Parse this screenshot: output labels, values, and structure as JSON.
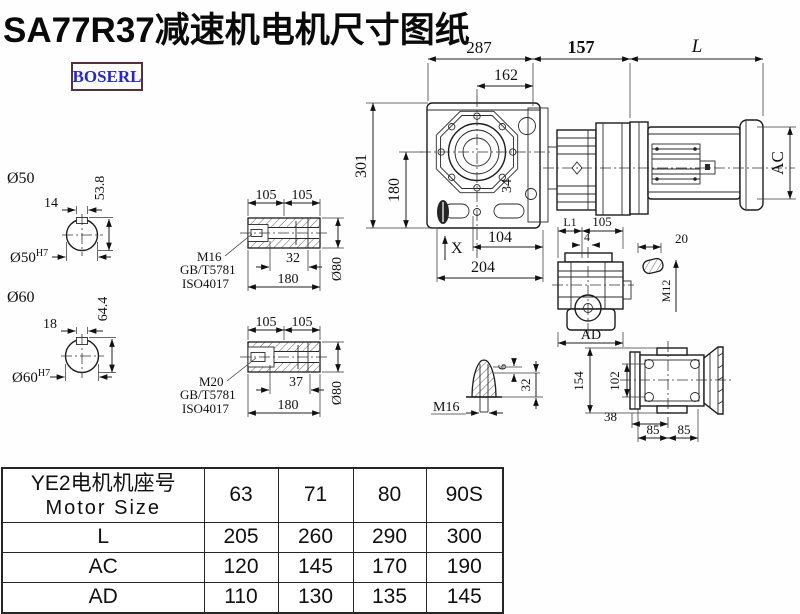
{
  "title": "SA77R37减速机电机尺寸图纸",
  "logo": "BOSERL",
  "main_view": {
    "d287": "287",
    "d162": "162",
    "d157": "157",
    "dL": "L",
    "d301": "301",
    "d180": "180",
    "d34": "34",
    "dX": "X",
    "d104": "104",
    "d204": "204",
    "dAC": "AC"
  },
  "shaft_hole_50": {
    "dia": "Ø50",
    "key_width": "14",
    "key_height": "53.8",
    "fit": "Ø50",
    "fit_tol": "H7"
  },
  "shaft_hole_60": {
    "dia": "Ø60",
    "key_width": "18",
    "key_height": "64.4",
    "fit": "Ø60",
    "fit_tol": "H7"
  },
  "bushing_a": {
    "d105_1": "105",
    "d105_2": "105",
    "thread": "M16",
    "std1": "GB/T5781",
    "std2": "ISO4017",
    "d_depth": "32",
    "d_len": "180",
    "d_dia": "Ø80"
  },
  "bushing_b": {
    "d105_1": "105",
    "d105_2": "105",
    "thread": "M20",
    "std1": "GB/T5781",
    "std2": "ISO4017",
    "d_depth": "37",
    "d_len": "180",
    "d_dia": "Ø80"
  },
  "side_view": {
    "dL1": "L1",
    "d105": "105",
    "d4": "4",
    "dAD": "AD",
    "d20": "20",
    "thread": "M12"
  },
  "rear_view": {
    "d154": "154",
    "d102": "102",
    "d38": "38",
    "d85_1": "85",
    "d85_2": "85"
  },
  "plug_view": {
    "d6": "6",
    "d32": "32",
    "thread": "M16"
  },
  "size_table": {
    "header_cn": "YE2电机机座号",
    "header_en": "Motor Size",
    "columns": [
      "63",
      "71",
      "80",
      "90S"
    ],
    "rows": [
      {
        "label": "L",
        "values": [
          "205",
          "260",
          "290",
          "300"
        ]
      },
      {
        "label": "AC",
        "values": [
          "120",
          "145",
          "170",
          "190"
        ]
      },
      {
        "label": "AD",
        "values": [
          "110",
          "130",
          "135",
          "145"
        ]
      }
    ]
  }
}
